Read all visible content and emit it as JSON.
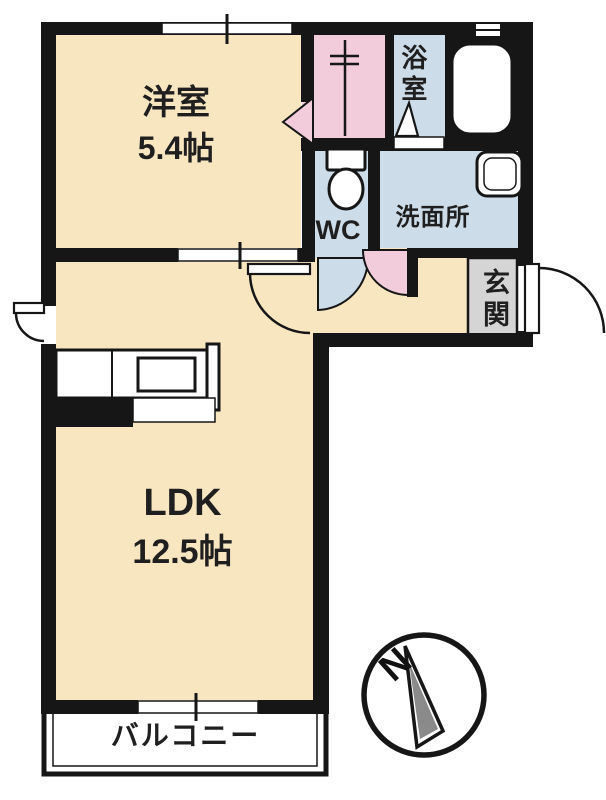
{
  "plan": {
    "rooms": {
      "western": {
        "label": "洋室",
        "area": "5.4帖"
      },
      "ldk": {
        "label": "LDK",
        "area": "12.5帖"
      },
      "wc": {
        "label": "WC"
      },
      "washroom": {
        "label": "洗面所"
      },
      "bath": {
        "label": "浴室"
      },
      "entrance": {
        "label": "玄関"
      },
      "balcony": {
        "label": "バルコニー"
      }
    },
    "compass": {
      "north": "N"
    },
    "colors": {
      "floor_cream": "#f8e6c1",
      "wet_area_blue": "#ccdce8",
      "closet_pink": "#f2ccdb",
      "entrance_gray": "#d5d5d5",
      "wall": "#161616",
      "needle_gray": "#8a8a8a"
    }
  }
}
